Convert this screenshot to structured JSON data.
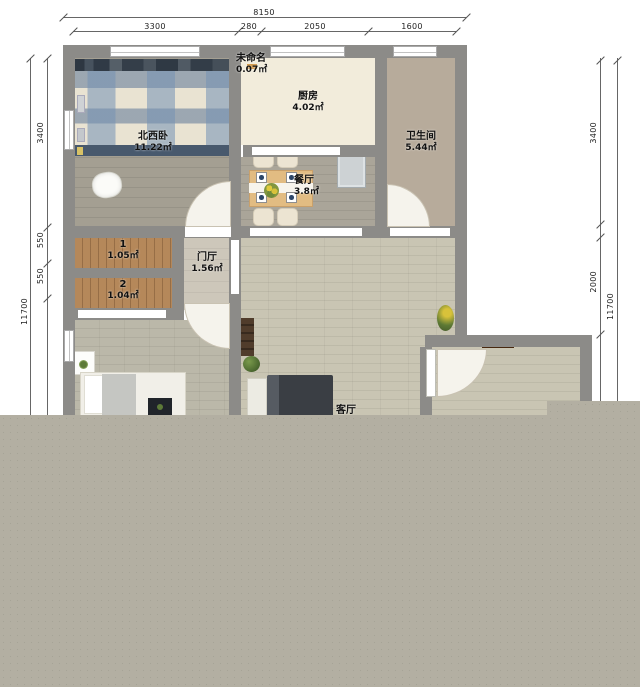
{
  "dims": {
    "top": {
      "total": "8150",
      "segments": [
        "3300",
        "280",
        "2050",
        "1600"
      ]
    },
    "left": {
      "total": "11700",
      "segments": [
        "3400",
        "550",
        "550"
      ]
    },
    "right": {
      "total": "11700",
      "segments": [
        "3400",
        "2000"
      ]
    }
  },
  "rooms": {
    "bedroom_nw": {
      "name": "北西卧",
      "area": "11.22㎡"
    },
    "unnamed": {
      "name": "未命名",
      "area": "0.07㎡"
    },
    "kitchen": {
      "name": "厨房",
      "area": "4.02㎡"
    },
    "bathroom": {
      "name": "卫生间",
      "area": "5.44㎡"
    },
    "dining": {
      "name": "餐厅",
      "area": "3.8㎡"
    },
    "closet1": {
      "name": "1",
      "area": "1.05㎡"
    },
    "closet2": {
      "name": "2",
      "area": "1.04㎡"
    },
    "hall": {
      "name": "门厅",
      "area": "1.56㎡"
    },
    "living": {
      "name": "客厅"
    }
  },
  "colors": {
    "wall": "#8c8b88",
    "overlay": "#b3afa2",
    "closet_wood": "#b5885a",
    "kitchen_floor": "#f2ecdb",
    "living_floor": "#c9c5b3"
  }
}
